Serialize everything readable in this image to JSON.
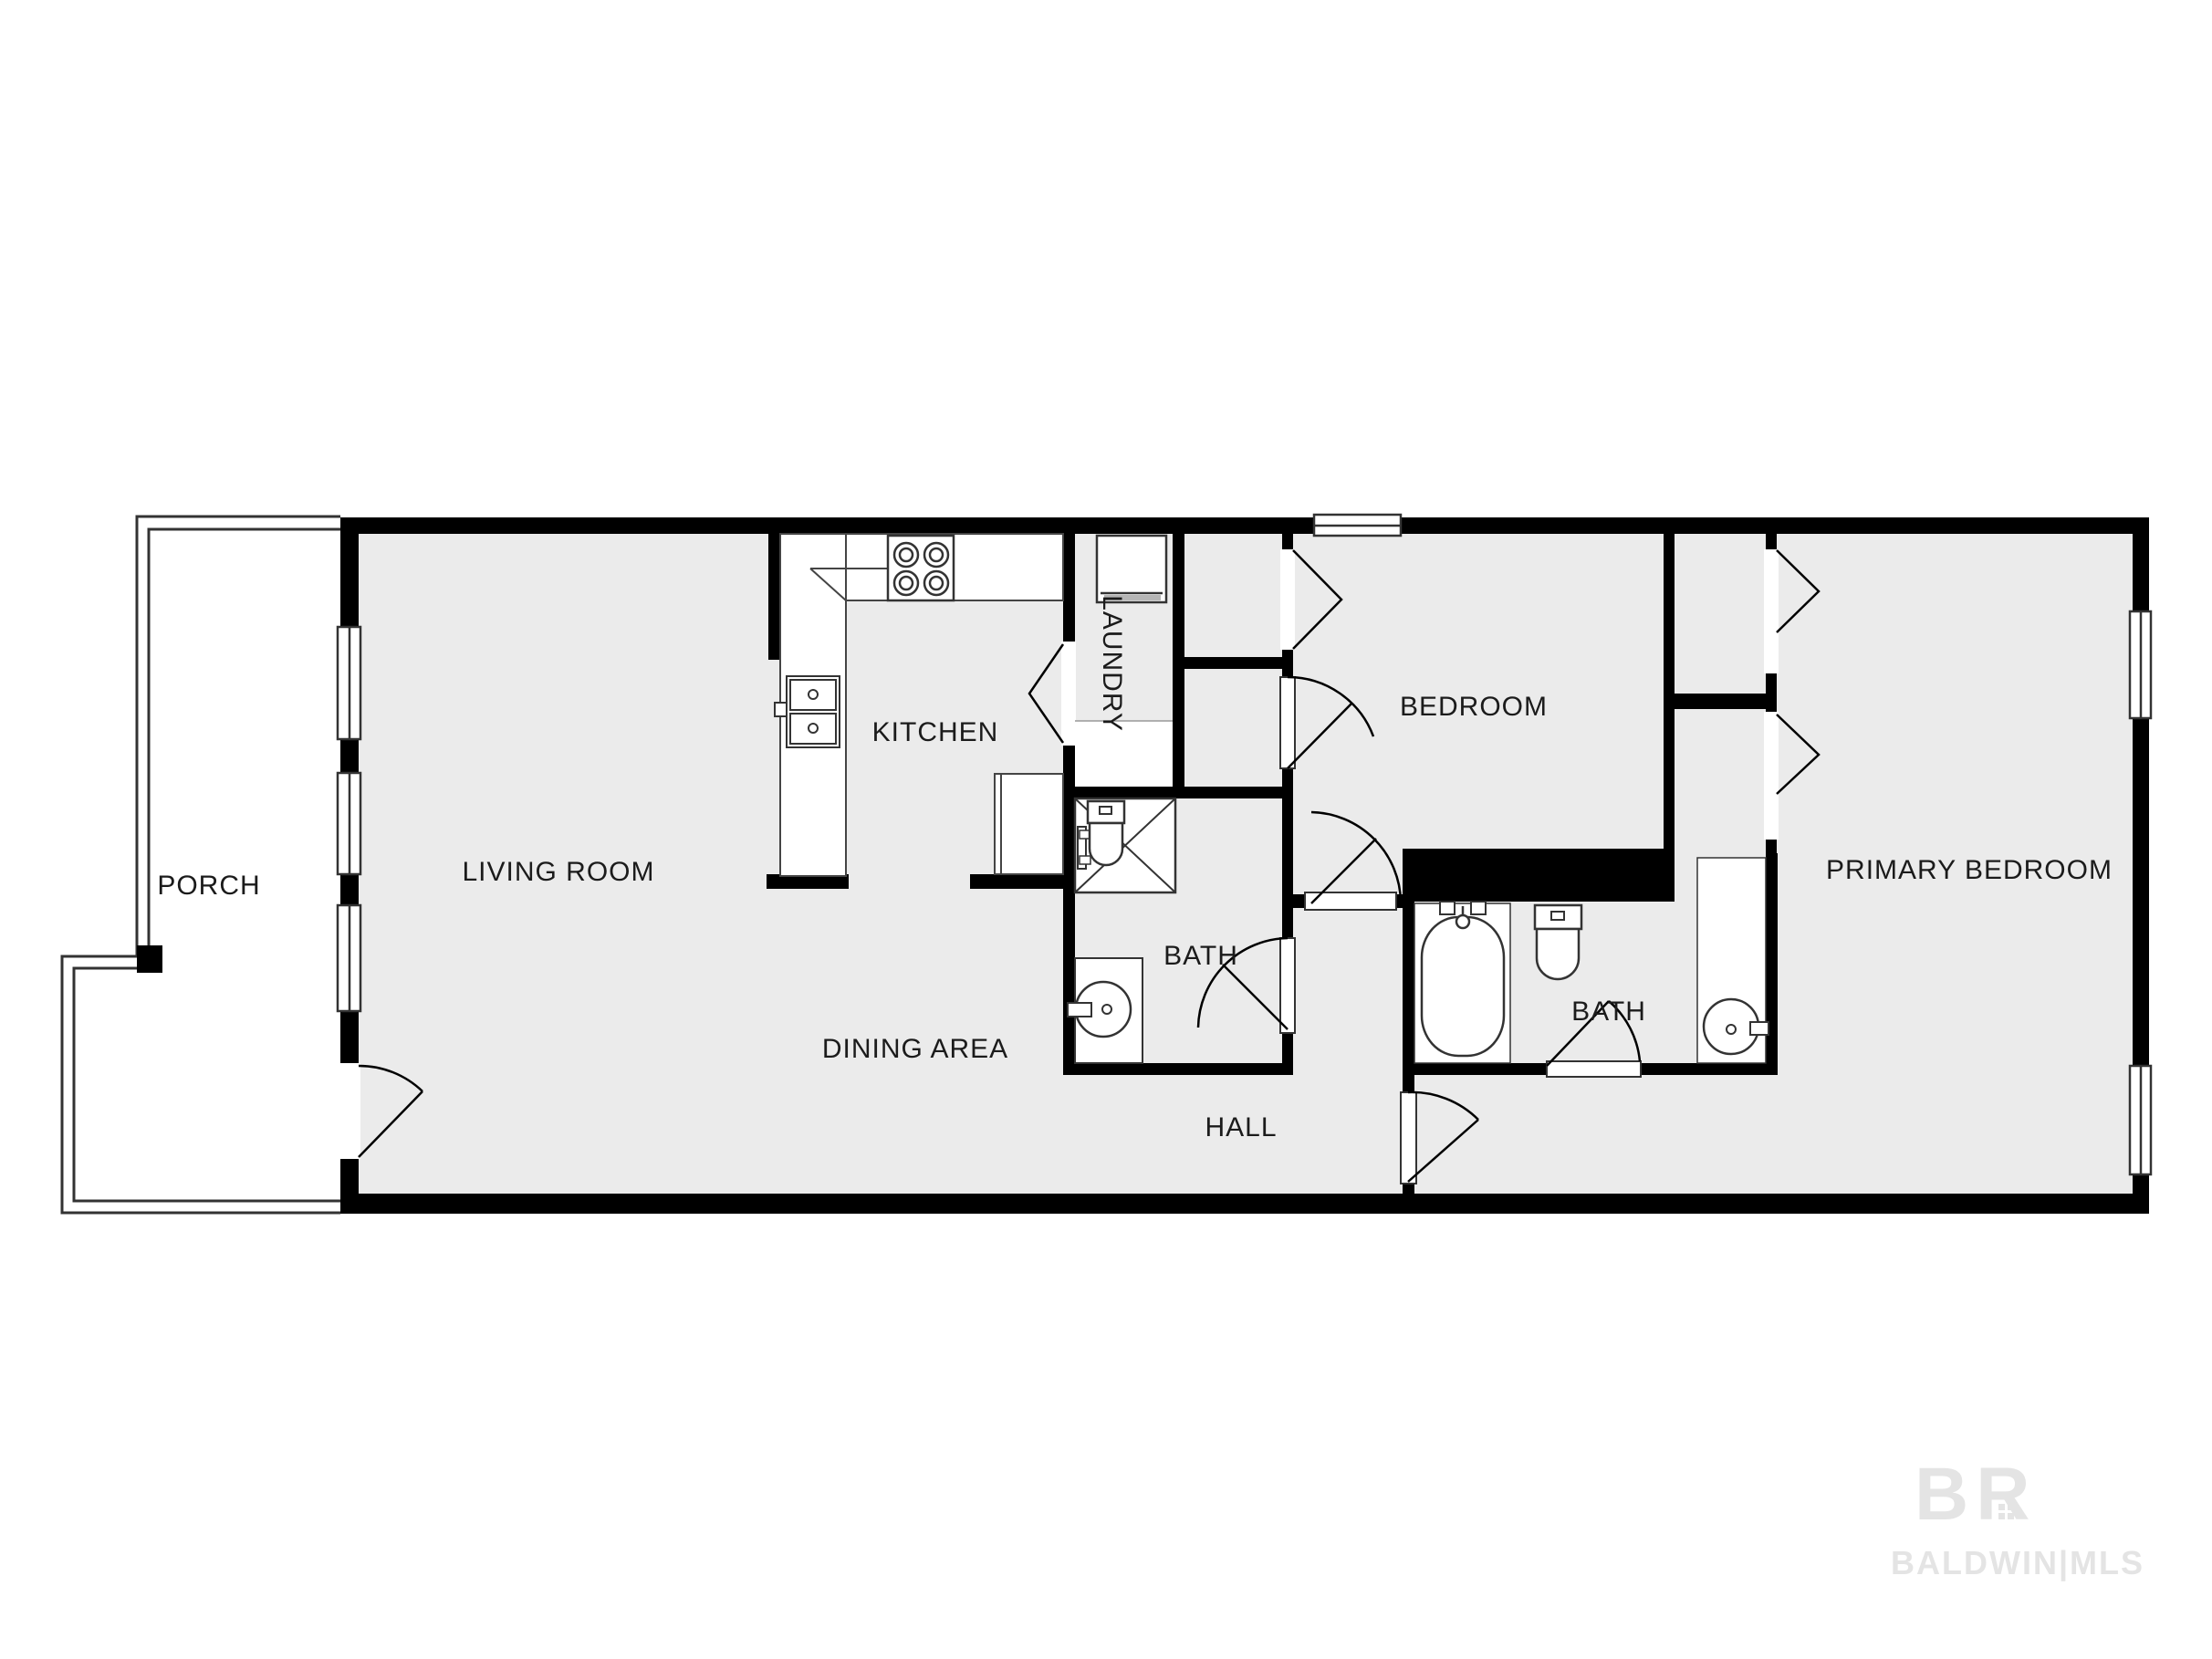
{
  "floorplan": {
    "rooms": [
      {
        "name": "porch",
        "label": "PORCH"
      },
      {
        "name": "living-room",
        "label": "LIVING ROOM"
      },
      {
        "name": "kitchen",
        "label": "KITCHEN"
      },
      {
        "name": "laundry",
        "label": "LAUNDRY"
      },
      {
        "name": "bedroom",
        "label": "BEDROOM"
      },
      {
        "name": "primary-bedroom",
        "label": "PRIMARY BEDROOM"
      },
      {
        "name": "hall-bath",
        "label": "BATH"
      },
      {
        "name": "primary-bath",
        "label": "BATH"
      },
      {
        "name": "dining-area",
        "label": "DINING AREA"
      },
      {
        "name": "hall",
        "label": "HALL"
      }
    ],
    "colors": {
      "wall": "#000000",
      "floor": "#ebebeb",
      "fixture_outline": "#333333",
      "label_text": "#1b1b1b",
      "watermark": "#e4e4e4"
    }
  },
  "watermark": {
    "logo": "BR",
    "text": "BALDWIN|MLS"
  }
}
